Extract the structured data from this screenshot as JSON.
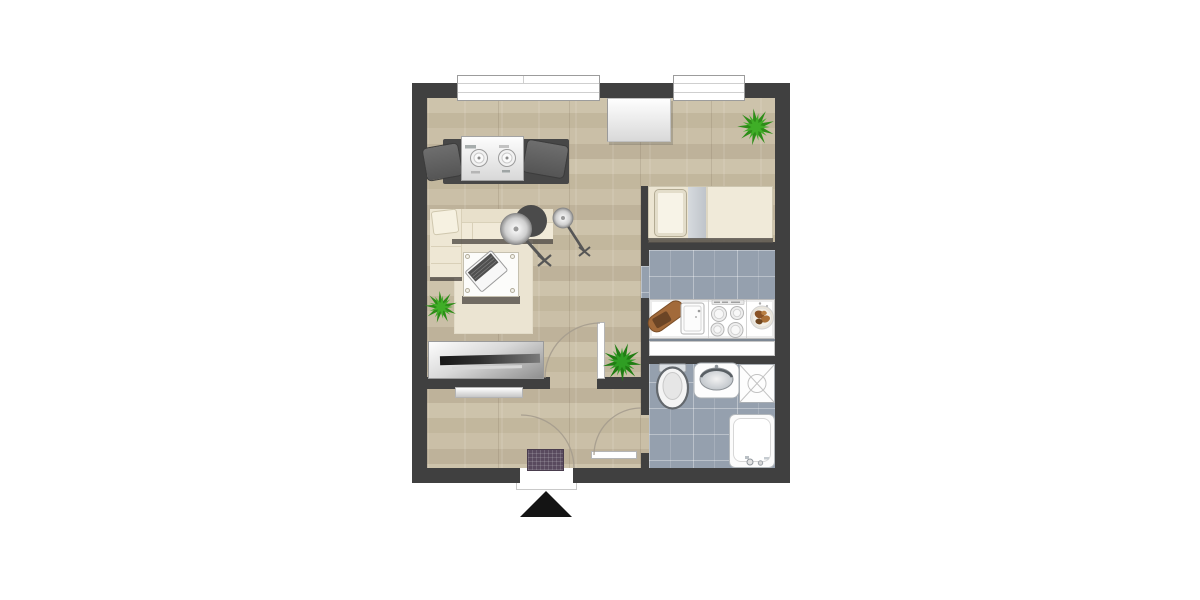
{
  "scene": {
    "type": "apartment-floor-plan",
    "view": "top-down",
    "rooms": [
      {
        "id": "living-sleeping-room",
        "floor": "wood-parquet"
      },
      {
        "id": "sleeping-nook",
        "floor": "wood-parquet"
      },
      {
        "id": "kitchen",
        "floor": "gray-tile"
      },
      {
        "id": "bathroom",
        "floor": "gray-tile"
      },
      {
        "id": "entry-hallway",
        "floor": "wood-parquet"
      }
    ],
    "windows": 2,
    "door_swings": 3,
    "plants": 3,
    "entry_marker": "black-triangle-south",
    "inventory": [
      "window",
      "window",
      "wardrobe",
      "palm-plant",
      "stereo-cabinet",
      "speaker",
      "speaker",
      "l-shaped-sofa",
      "throw-pillow",
      "area-rug",
      "coffee-table",
      "laptop",
      "floor-lamp-large",
      "floor-lamp-small",
      "palm-plant",
      "sideboard",
      "tv-soundbar",
      "hall-shelf",
      "doormat",
      "pine-plant",
      "single-bed",
      "bed-pillow",
      "kitchen-counter",
      "cutting-board",
      "kitchen-sink",
      "stove-4-burners",
      "serving-bowl",
      "utility-cabinet",
      "toilet",
      "washbasin",
      "shower",
      "bathtub",
      "entry-arrow"
    ]
  },
  "colors": {
    "bg": "#ffffff",
    "wall": "#404040",
    "wood_a": "#cdc3ab",
    "wood_b": "#c2b79d",
    "wood_c": "#cabfa7",
    "wood_d": "#beb29a",
    "wood_seam": "rgba(110,95,75,0.18)",
    "tile": "#95a0ae",
    "grout": "rgba(255,255,255,0.35)",
    "cream": "#efe8d6",
    "rug": "#ebe4d2",
    "shadow": "#56514b",
    "frame_gray": "#9c9c9c",
    "backdrop_gray": "#474747",
    "doormat": "#594a5e",
    "palm_light": "#3fae27",
    "palm_dark": "#2d8d18",
    "pine_light": "#2f9e23",
    "pine_dark": "#207d13",
    "board_brown": "#a26a3a",
    "board_dark": "#6b4526",
    "arc": "#a59c8e",
    "arrow": "#141414"
  }
}
